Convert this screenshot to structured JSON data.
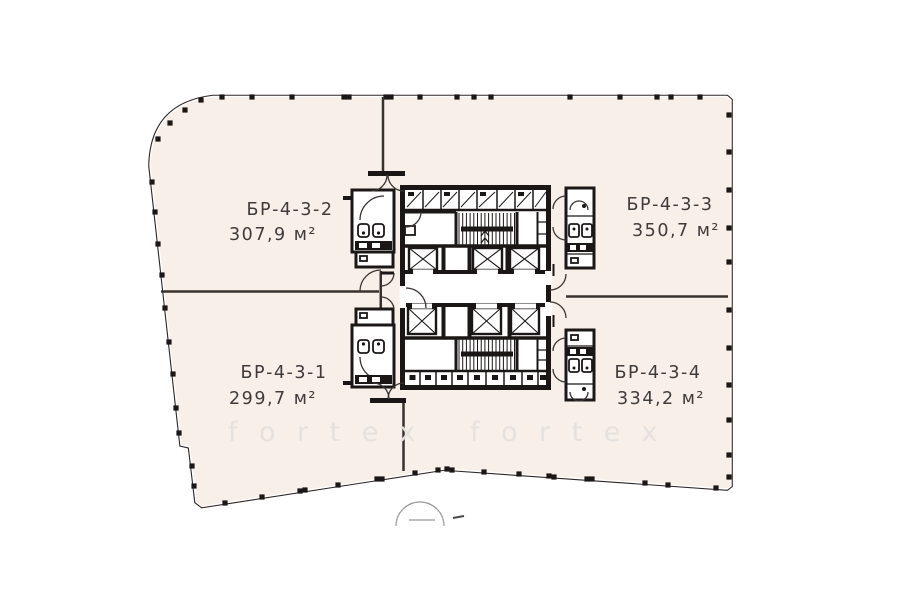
{
  "units": [
    {
      "code": "БР-4-3-1",
      "area": "299,7 м²"
    },
    {
      "code": "БР-4-3-2",
      "area": "307,9 м²"
    },
    {
      "code": "БР-4-3-3",
      "area": "350,7 м²"
    },
    {
      "code": "БР-4-3-4",
      "area": "334,2 м²"
    }
  ],
  "watermark": {
    "text": "fortex",
    "text2": "fortex"
  },
  "colors": {
    "unit_fill": "#f9efe9",
    "wall": "#1b1717",
    "outline": "#2c2726",
    "watermark": "#e4e1de"
  }
}
